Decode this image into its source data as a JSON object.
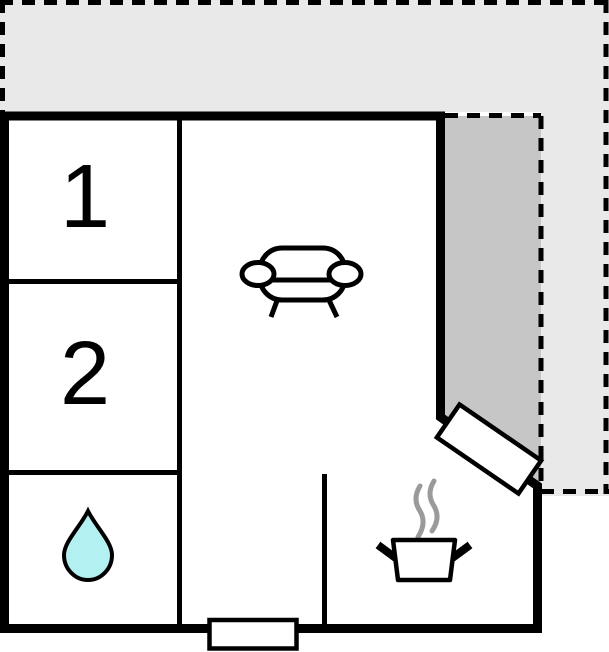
{
  "floorplan": {
    "rooms": {
      "bedroom_1": {
        "label": "1"
      },
      "bedroom_2": {
        "label": "2"
      }
    },
    "icons": [
      {
        "name": "water-drop-icon"
      },
      {
        "name": "sofa-icon"
      },
      {
        "name": "cooking-pot-icon"
      },
      {
        "name": "steam-icon"
      }
    ],
    "colors": {
      "terrace": "#e9e9e9",
      "patio": "#c6c6c6",
      "wall": "#000000",
      "floor": "#ffffff",
      "water_drop": "#b3f0f2",
      "steam": "#9a9a9a"
    }
  }
}
